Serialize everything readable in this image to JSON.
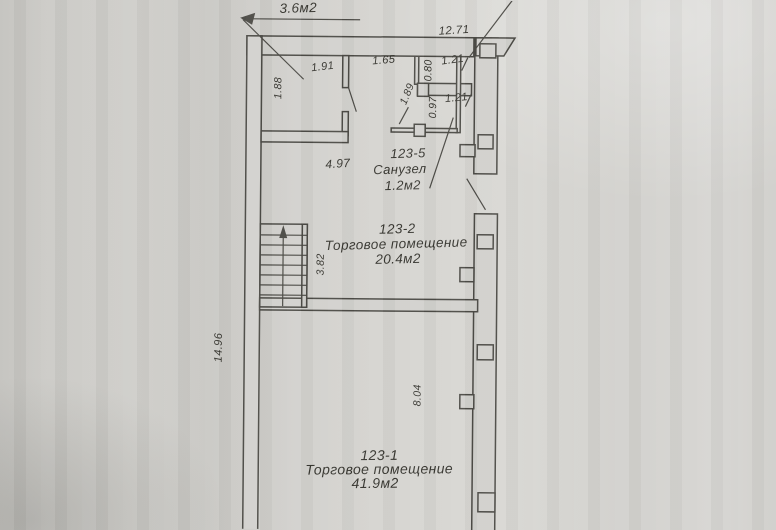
{
  "document": {
    "kind": "scanned technical floor plan",
    "language": "Russian"
  },
  "plan": {
    "area_note": "3.6м2",
    "dimensions": {
      "top_width": "12.71",
      "left_height": "14.96",
      "room_top_width": "1.91",
      "room_top_height": "1.88",
      "wall_seg_165": "1.65",
      "niche_width_121": "1.21",
      "niche_height_080": "0.80",
      "bath_diag_189": "1.89",
      "bath_height_097": "0.97",
      "bath_width_121": "1.21",
      "corridor_width": "4.97",
      "room2_height": "3.82",
      "room1_height": "8.04"
    },
    "rooms": [
      {
        "id": "123-5",
        "name": "Санузел",
        "area": "1.2м2"
      },
      {
        "id": "123-2",
        "name": "Торговое помещение",
        "area": "20.4м2"
      },
      {
        "id": "123-1",
        "name": "Торговое помещение",
        "area": "41.9м2"
      }
    ],
    "colors": {
      "paper": "#d2d1cd",
      "ink": "#4b4a45",
      "text": "#36352f"
    }
  }
}
